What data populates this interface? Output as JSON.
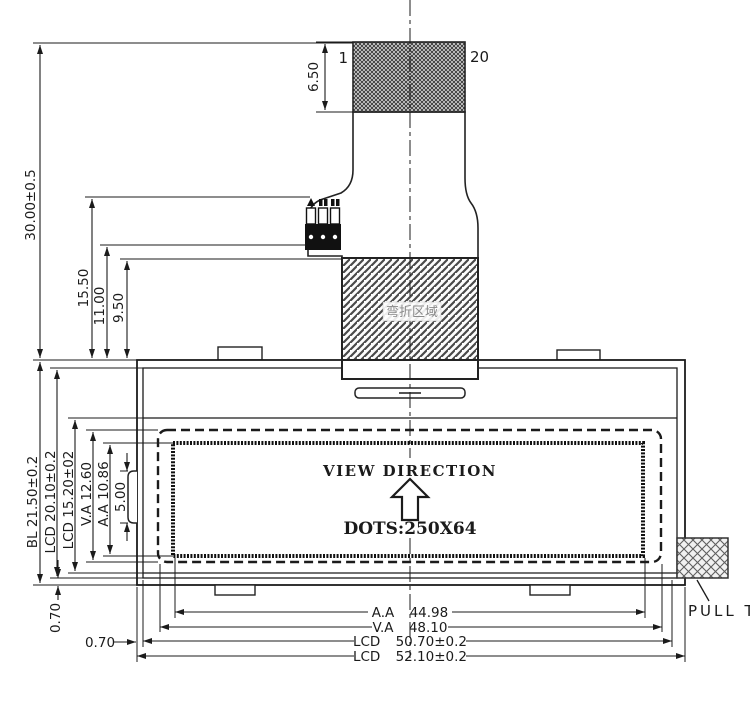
{
  "drawing": {
    "connector": {
      "pin_start": "1",
      "pin_end": "20",
      "height": "6.50"
    },
    "left_dims": {
      "overall": "30.00±0.5",
      "fpc_len": "15.50",
      "fpc_mid": "11.00",
      "fpc_short": "9.50"
    },
    "side_dims": {
      "bl": "BL 21.50±0.2",
      "lcd": "LCD 20.10±0.2",
      "lcd_glass": "LCD 15.20±02",
      "va": "V.A 12.60",
      "aa": "A.A 10.86",
      "tab": "5.00",
      "edge_v": "0.70"
    },
    "bottom_dims": {
      "aa": "A.A 44.98",
      "va": "V.A 48.10",
      "lcd_inner": "LCD 50.70±0.2",
      "lcd_outer": "LCD 52.10±0.2",
      "edge_h": "0.70"
    },
    "screen": {
      "view_direction": "VIEW DIRECTION",
      "dots": "DOTS:250X64"
    },
    "bend_area": "弯折区域",
    "pull_tab": "PULL TAB",
    "colors": {
      "line": "#1b1b1b",
      "hatch_dark": "#3d3d3d",
      "hatch_gray": "#6a6a6a"
    }
  }
}
